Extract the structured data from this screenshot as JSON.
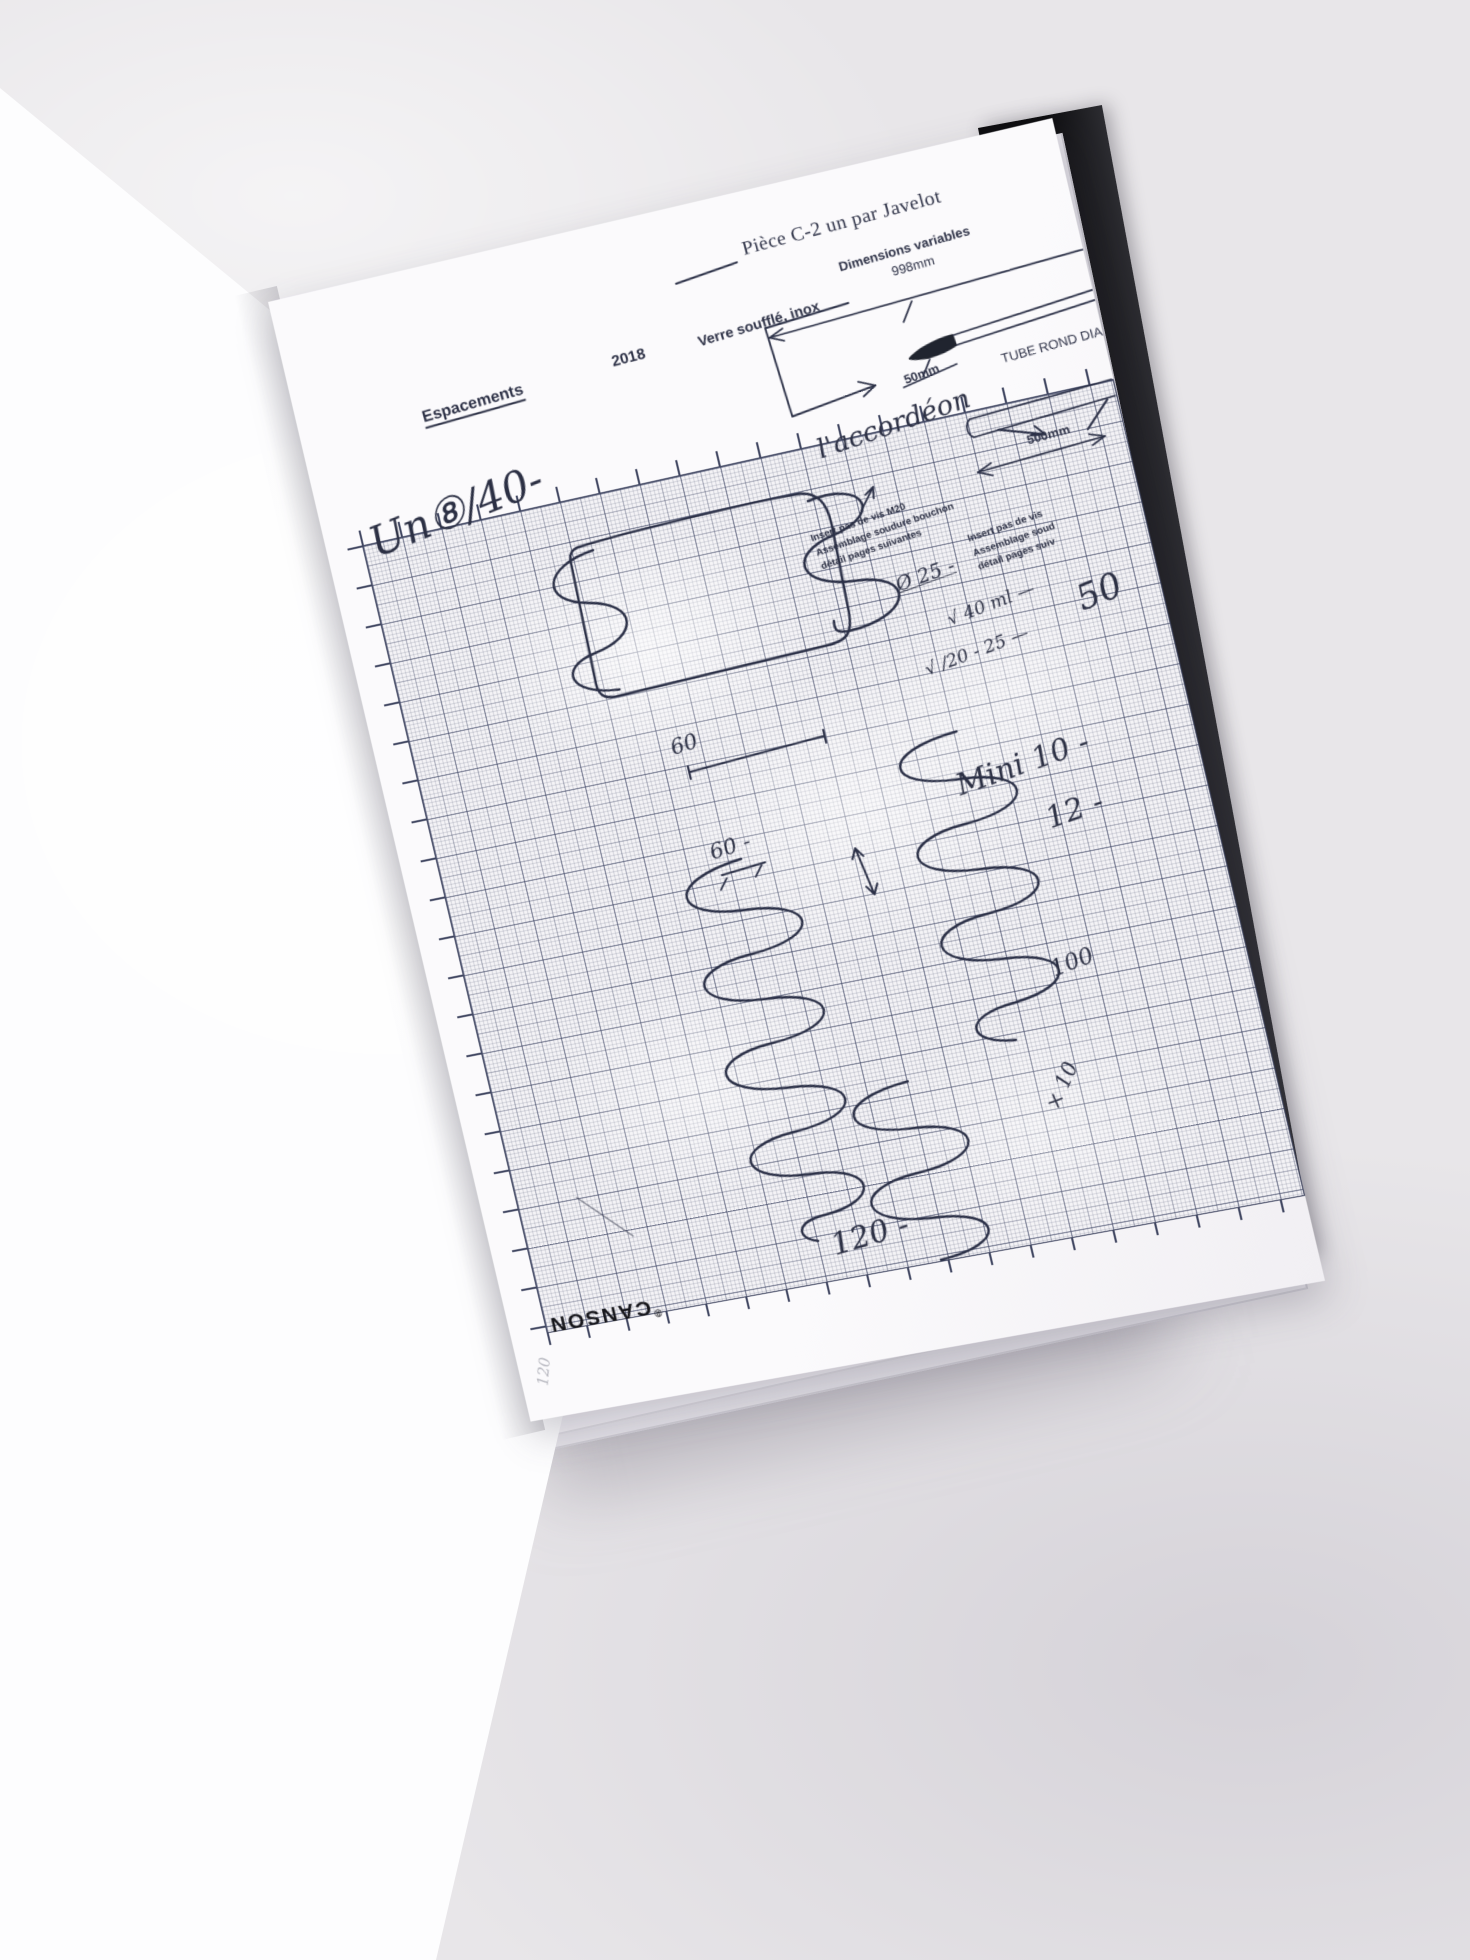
{
  "book": {
    "brand": "CANSON",
    "brand_mark": "®",
    "page_number": "120"
  },
  "header": {
    "year": "2018",
    "series": "Espacements",
    "title": "Pièce C-2 un par Javelot",
    "dimensions": "Dimensions variables",
    "material": "Verre soufflé, inox",
    "total_length": "998mm",
    "tip_length": "50mm",
    "tube_label": "TUBE ROND DIAM",
    "tube_length": "500mm"
  },
  "notes": {
    "top_left": "Un⑧/40-",
    "accordion": "l'accordéon",
    "insert_note_a": {
      "line1": "Insert pas de vis M20",
      "line2": "Assemblage soudure bouchon",
      "line3": "détail pages suivantes"
    },
    "insert_note_b": {
      "line1": "Insert pas de vis",
      "line2": "Assemblage soud",
      "line3": "détail pages suiv"
    },
    "fifty": "50",
    "diameter": "Ø 25 -",
    "forty_ml": "√ 40 ml —",
    "range_20_25": "√ /20 - 25 —",
    "mini": "Mini 10 -",
    "twelve": "12 -",
    "sixty_a": "60",
    "sixty_b": "60 -",
    "hundred": "100",
    "x_ten": "× 10",
    "one_twenty": "120 -"
  },
  "colors": {
    "ink": "#2c3044",
    "grid_line": "#3f4560",
    "paper": "#fbfafc",
    "cover": "#0b0b0d",
    "table": "#e8e6e9"
  }
}
